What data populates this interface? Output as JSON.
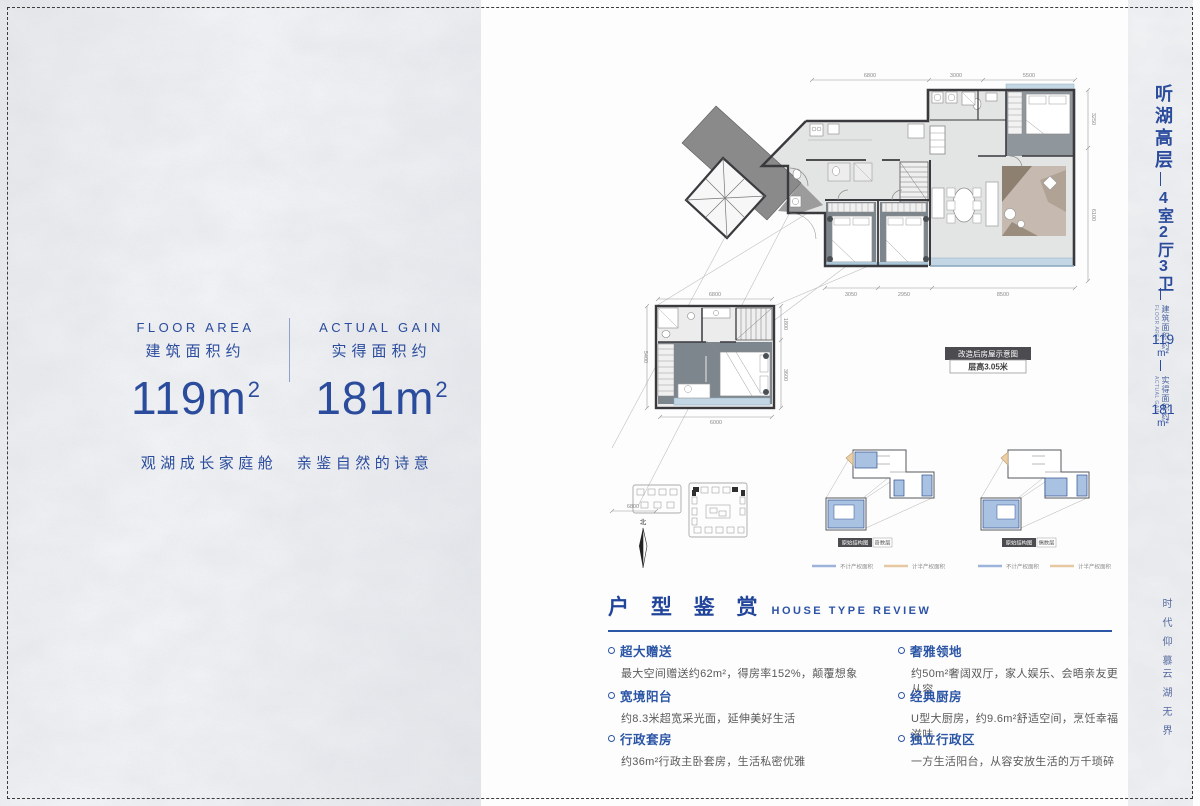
{
  "colors": {
    "accent": "#2b4c9d",
    "wall": "#3a3a3e",
    "balcony": "#c3d6e4",
    "dark_floor": "#7e868d",
    "legend_blue": "#9db4da",
    "legend_orange": "#e6c9a2"
  },
  "left_panel": {
    "floor_area": {
      "en": "FLOOR AREA",
      "zh": "建筑面积约",
      "num": "119m",
      "sup": "2"
    },
    "actual_gain": {
      "en": "ACTUAL GAIN",
      "zh": "实得面积约",
      "num": "181m",
      "sup": "2"
    },
    "tagline": "观湖成长家庭舱　亲鉴自然的诗意"
  },
  "sidebar": {
    "title": "听湖高层",
    "subtitle": "4室2厅3卫",
    "floor_area": {
      "zh": "建筑面积约",
      "en": "FLOOR AREA",
      "num": "119",
      "unit": "m²"
    },
    "actual_gain": {
      "zh": "实得面积约",
      "en": "ACTUAL GAIN",
      "num": "181",
      "unit": "m²"
    },
    "slogan_top": "时代仰慕",
    "slogan_bottom": "云湖无界"
  },
  "floor_plan": {
    "main": {
      "dims_top": [
        "6800",
        "3000",
        "5500"
      ],
      "dims_right": [
        "3250",
        "6100"
      ],
      "dims_bottom": [
        "3050",
        "2950",
        "8500"
      ]
    },
    "loft": {
      "top": "6800",
      "left": "5400",
      "right_top": "1800",
      "right_bottom": "3600",
      "bottom": "6000"
    },
    "extra_dim": "6800",
    "badge": {
      "title": "改造后房屋示意图",
      "subtitle": "层高3.05米"
    },
    "north": "北"
  },
  "diagrams": {
    "badge_label": "原始结构图",
    "left_tag": "奇数层",
    "right_tag": "偶数层",
    "legend_no_count": "不计产权面积",
    "legend_half_count": "计半产权面积"
  },
  "review": {
    "title_zh": "户 型 鉴 赏",
    "title_en": "HOUSE TYPE REVIEW",
    "items": [
      {
        "title": "超大赠送",
        "body": "最大空间赠送约62m²，得房率152%，颠覆想象"
      },
      {
        "title": "宽境阳台",
        "body": "约8.3米超宽采光面，延伸美好生活"
      },
      {
        "title": "行政套房",
        "body": "约36m²行政主卧套房，生活私密优雅"
      },
      {
        "title": "奢雅领地",
        "body": "约50m²奢阔双厅，家人娱乐、会晤亲友更从容"
      },
      {
        "title": "经典厨房",
        "body": "U型大厨房，约9.6m²舒适空间，烹饪幸福滋味"
      },
      {
        "title": "独立行政区",
        "body": "一方生活阳台，从容安放生活的万千琐碎"
      }
    ]
  }
}
